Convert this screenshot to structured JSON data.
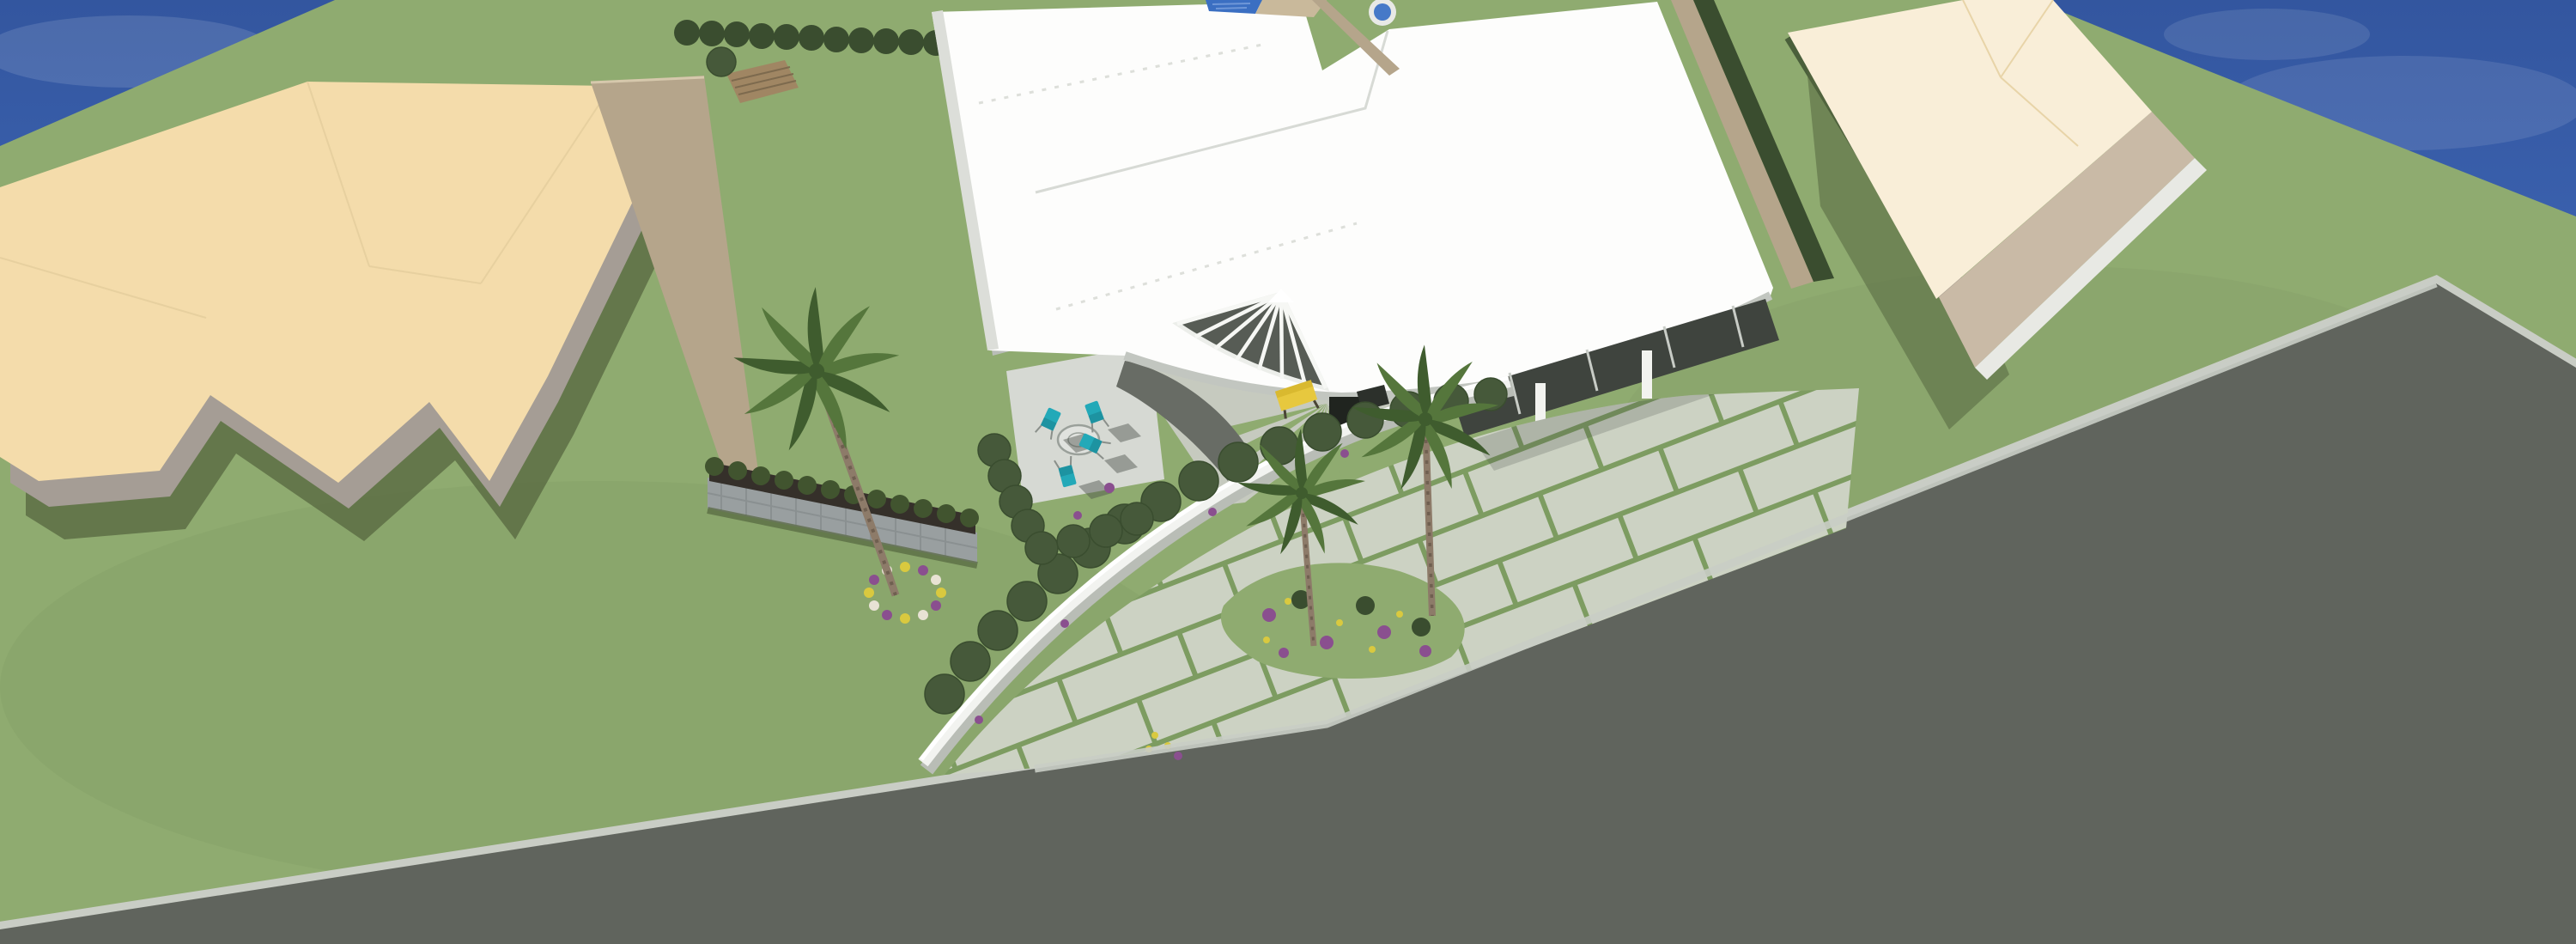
{
  "scene": {
    "label": "Aerial 3D architectural render of a modern white flat-roof house",
    "subject": "modern-house-with-curved-entrance-canopy",
    "setting": "suburban-corner-lot-with-lawn-palms-and-road"
  },
  "counts": {
    "patio_chairs": 4,
    "palm_trees": 3,
    "neighbor_buildings": 2
  },
  "objects": [
    {
      "id": "sky",
      "label": "blue sky"
    },
    {
      "id": "lawn",
      "label": "green lawn"
    },
    {
      "id": "road",
      "label": "dark asphalt road"
    },
    {
      "id": "curb",
      "label": "light concrete curb"
    },
    {
      "id": "left-neighbor-house",
      "label": "beige hip-roof neighbor house"
    },
    {
      "id": "right-neighbor-house",
      "label": "cream hip-roof neighbor house"
    },
    {
      "id": "main-house",
      "label": "white flat-roof modern house"
    },
    {
      "id": "entrance-canopy",
      "label": "curved entry canopy with fan louver"
    },
    {
      "id": "fan-louver",
      "label": "radial louver cutout"
    },
    {
      "id": "driveway",
      "label": "paver driveway with grass joints"
    },
    {
      "id": "garden-wall",
      "label": "curved white garden wall"
    },
    {
      "id": "hedge-row",
      "label": "rounded hedge bushes"
    },
    {
      "id": "patio",
      "label": "concrete patio with table and chairs"
    },
    {
      "id": "pool",
      "label": "blue tiled pool edge"
    },
    {
      "id": "spa",
      "label": "round spa"
    },
    {
      "id": "bench",
      "label": "yellow entry bench"
    },
    {
      "id": "planter-wall",
      "label": "stone planter wall"
    },
    {
      "id": "flower-ring",
      "label": "flower ring around palm"
    },
    {
      "id": "flower-bed",
      "label": "purple and yellow flower patches"
    }
  ],
  "colors": {
    "sky": "#3e66b5",
    "sky_deep": "#33569f",
    "grass": "#8fab70",
    "grass_shadow": "#5f7649",
    "road": "#60645d",
    "curb": "#c9cdc5",
    "roof_white": "#fdfdfc",
    "roof_edge": "#d2d5d0",
    "fascia": "#c2c6c0",
    "wall_gray": "#a59d95",
    "concrete": "#d6d9d3",
    "courtyard": "#c6cabf",
    "paver": "#ccd2c3",
    "paver_joint": "#7d9c61",
    "hedge": "#46593a",
    "hedge_dark": "#3a4d2f",
    "planter_soil": "#35302a",
    "palm_green": "#55763c",
    "palm_dark": "#3f5c2e",
    "trunk": "#8d7b69",
    "roof_beige": "#f4dcab",
    "ridge_beige": "#e3cd9c",
    "roof_cream": "#f9eed8",
    "wall_tan": "#b5a58b",
    "wall_tan_light": "#c9baa6",
    "wall_dark": "#9d9488",
    "gabion": "#999fa0",
    "pool_blue": "#3b6fc2",
    "spa_water": "#4679c8",
    "chair_teal": "#23a9b8",
    "bench_yellow": "#e7c83e",
    "flower_purple": "#8a4f8f",
    "flower_yellow": "#d9c93f",
    "glass_dark": "#3f443e",
    "door_dark": "#20241f",
    "ramp": "#686c65",
    "shadow": "#55663f"
  }
}
